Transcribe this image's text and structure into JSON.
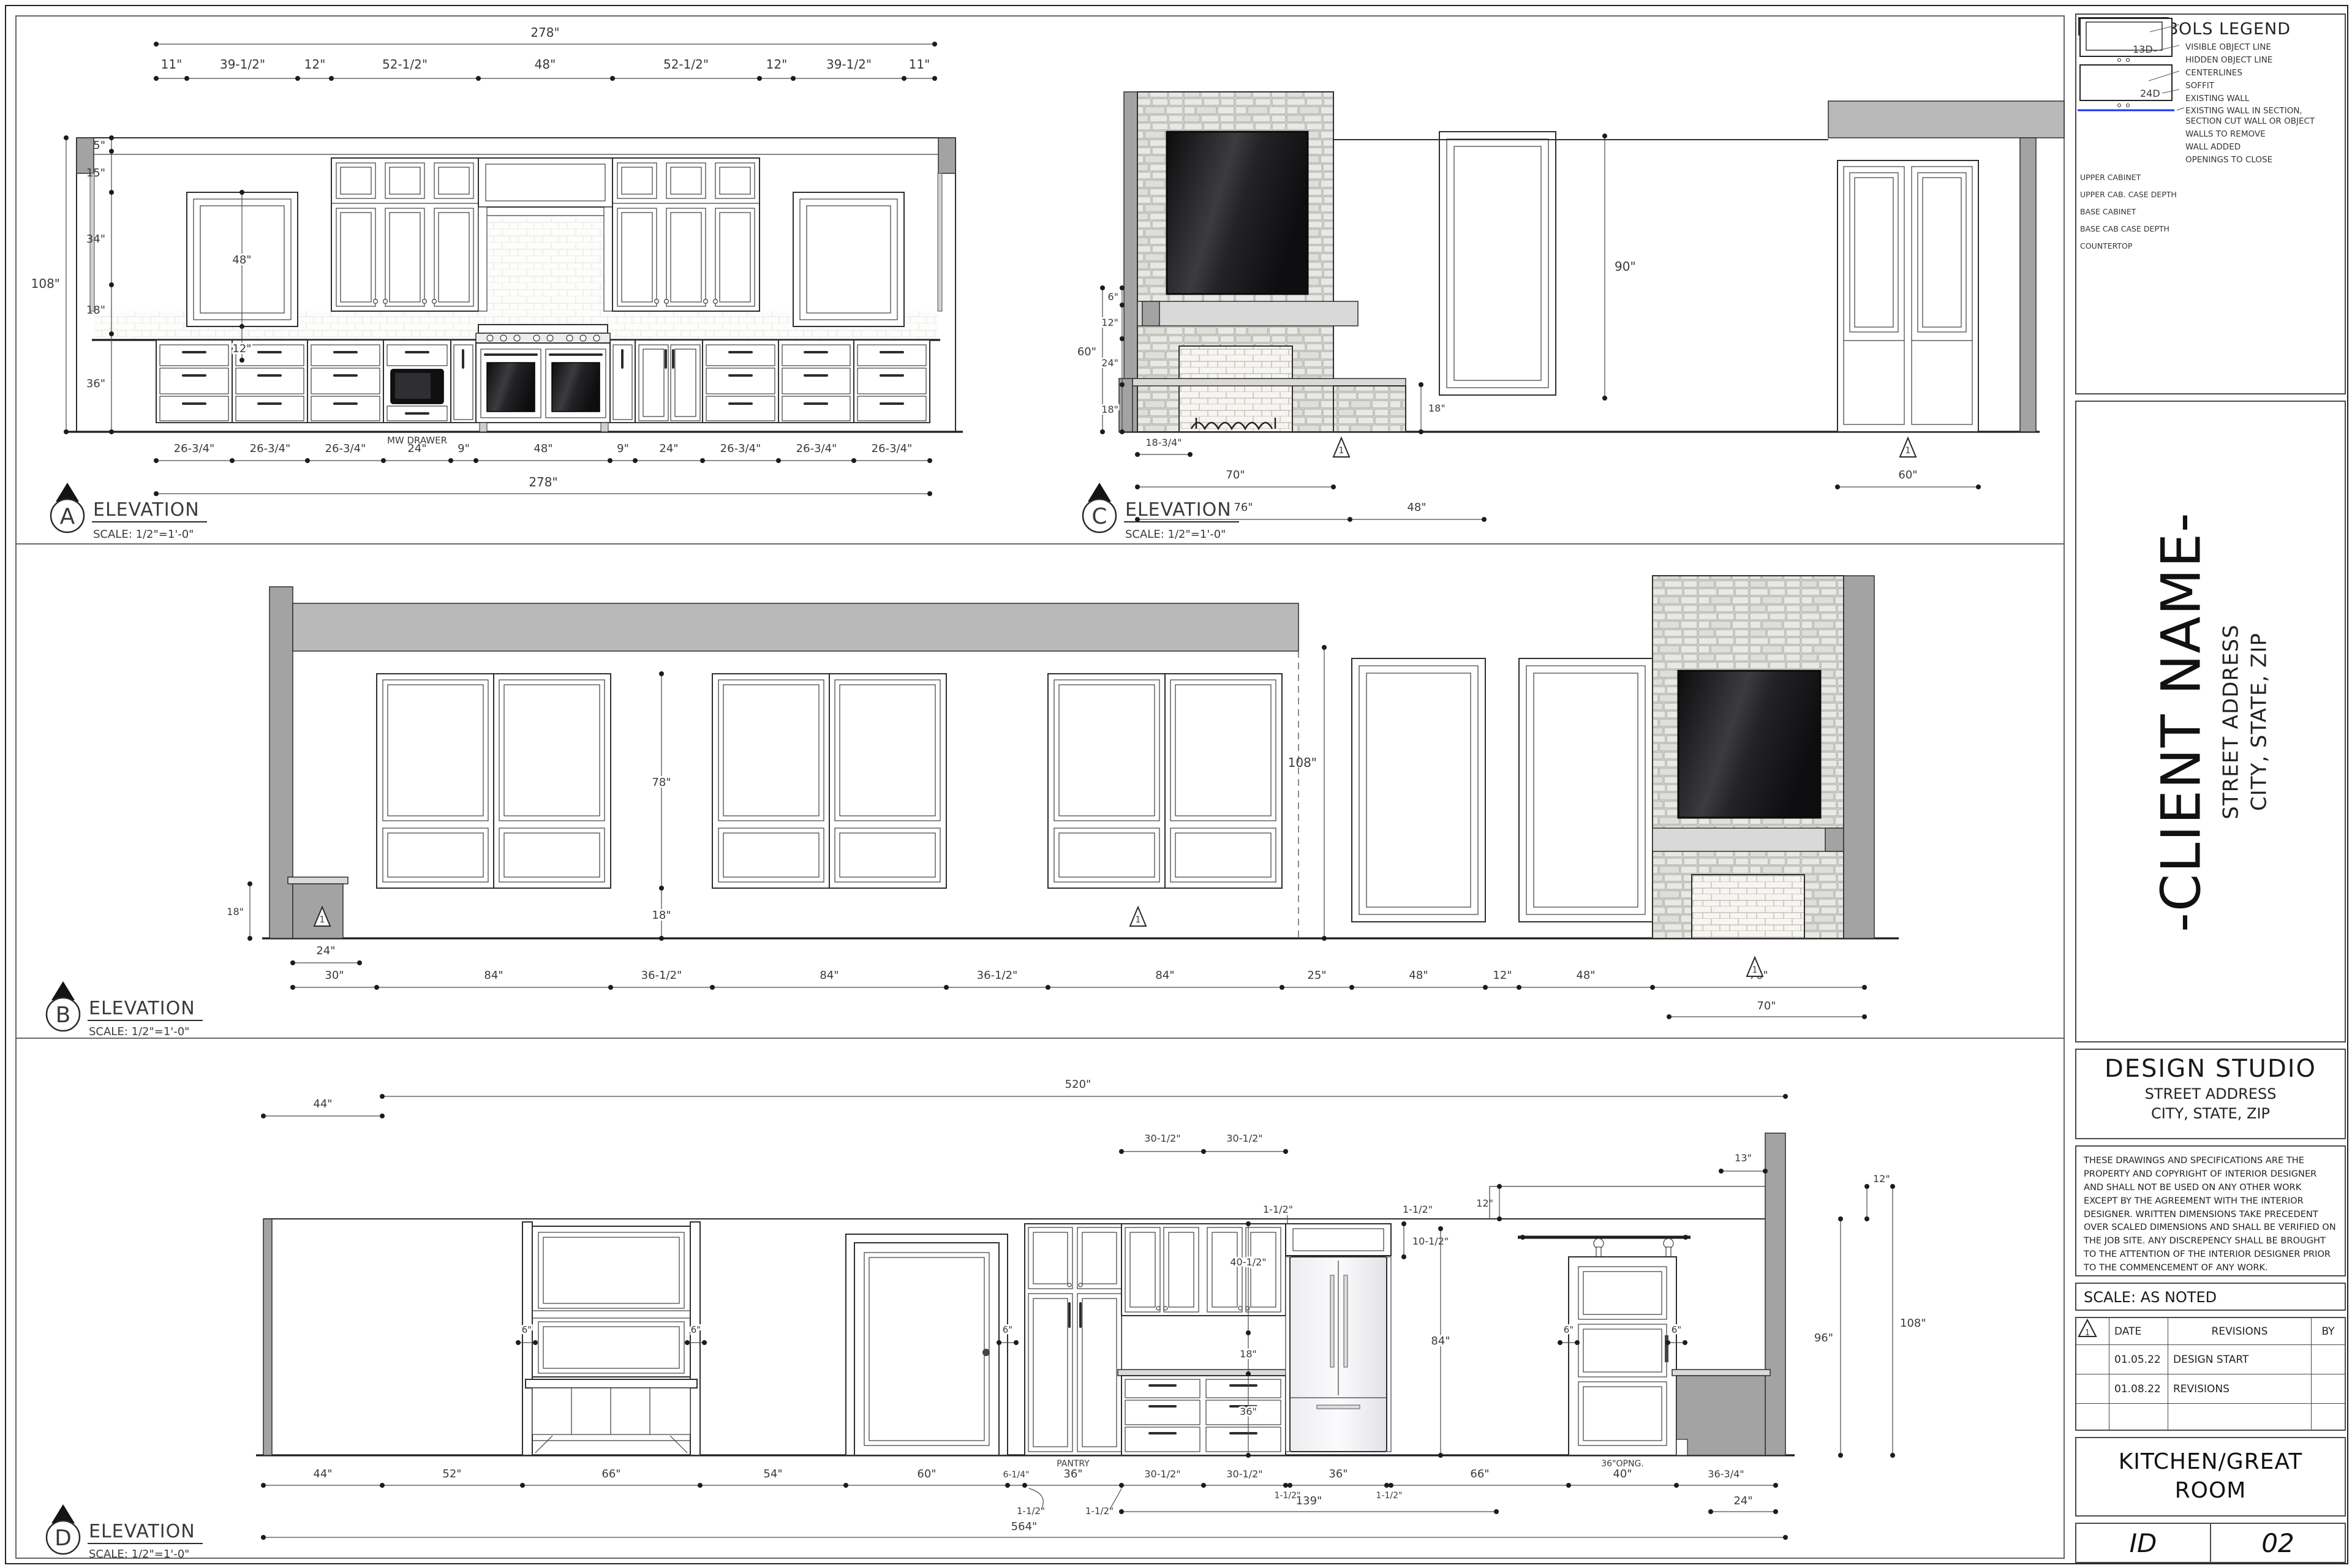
{
  "common": {
    "title": "ELEVATION",
    "scale": "SCALE: 1/2\"=1'-0\""
  },
  "elev_a": {
    "marker": "A",
    "overall_top": "278\"",
    "top": [
      "11\"",
      "39-1/2\"",
      "12\"",
      "52-1/2\"",
      "48\"",
      "52-1/2\"",
      "12\"",
      "39-1/2\"",
      "11\""
    ],
    "left": [
      "5\"",
      "15\"",
      "34\"",
      "18\"",
      "36\""
    ],
    "left_overall": "108\"",
    "win_h": "48\"",
    "sill": "12\"",
    "bottom": [
      "26-3/4\"",
      "26-3/4\"",
      "26-3/4\"",
      "24\"",
      "9\"",
      "48\"",
      "9\"",
      "24\"",
      "26-3/4\"",
      "26-3/4\"",
      "26-3/4\""
    ],
    "overall_bottom": "278\"",
    "mw": "MW DRAWER"
  },
  "elev_c": {
    "marker": "C",
    "left": [
      "6\"",
      "12\"",
      "24\"",
      "18\""
    ],
    "left_overall": "60\"",
    "hearth": "18\"",
    "door_h": "90\"",
    "bottom": [
      "18-3/4\"",
      "70\"",
      "76\"",
      "48\"",
      "60\""
    ],
    "rev": "1"
  },
  "elev_b": {
    "marker": "B",
    "win_h": "78\"",
    "below": "18\"",
    "height": "108\"",
    "cab": "24\"",
    "bottom": [
      "30\"",
      "84\"",
      "36-1/2\"",
      "84\"",
      "36-1/2\"",
      "84\"",
      "25\"",
      "48\"",
      "12\"",
      "48\"",
      "76\""
    ],
    "sub": "70\"",
    "rev": "1"
  },
  "elev_d": {
    "marker": "D",
    "top44": "44\"",
    "top520": "520\"",
    "top305a": "30-1/2\"",
    "top305b": "30-1/2\"",
    "top13": "13\"",
    "d12a": "12\"",
    "d12b": "12\"",
    "d15a": "1-1/2\"",
    "d15b": "1-1/2\"",
    "d105": "10-1/2\"",
    "cab405": "40-1/2\"",
    "gap18": "18\"",
    "base36": "36\"",
    "h84": "84\"",
    "h96": "96\"",
    "h108": "108\"",
    "six": "6\"",
    "bottom": [
      "44\"",
      "52\"",
      "66\"",
      "54\"",
      "60\"",
      "6-1/4\"",
      "36\"",
      "30-1/2\"",
      "30-1/2\"",
      "1-1/2\"",
      "36\"",
      "1-1/2\"",
      "66\"",
      "40\"",
      "36-3/4\""
    ],
    "pantry": "PANTRY",
    "opng": "36\"OPNG.",
    "low15a": "1-1/2\"",
    "low15b": "1-1/2\"",
    "d139": "139\"",
    "d24": "24\"",
    "overall": "564\""
  },
  "legend": {
    "title": "SYMBOLS LEGEND",
    "items": [
      "VISIBLE OBJECT LINE",
      "HIDDEN OBJECT LINE",
      "CENTERLINES",
      "SOFFIT",
      "EXISTING WALL",
      "EXISTING WALL IN SECTION, SECTION CUT WALL OR OBJECT",
      "WALLS TO REMOVE",
      "WALL ADDED",
      "OPENINGS TO CLOSE"
    ],
    "cl_symbol": "℄",
    "cab": {
      "upper": "UPPER CABINET",
      "upper_depth": "UPPER CAB. CASE DEPTH",
      "upper_depth_val": "13D",
      "base": "BASE CABINET",
      "base_depth": "BASE CAB CASE DEPTH",
      "base_depth_val": "24D",
      "countertop": "COUNTERTOP"
    }
  },
  "client": {
    "name": "-CLIENT NAME-",
    "address": "STREET ADDRESS",
    "city": "CITY, STATE, ZIP"
  },
  "studio": {
    "name": "DESIGN STUDIO",
    "address": "STREET ADDRESS",
    "city": "CITY, STATE, ZIP"
  },
  "disclaimer": "THESE DRAWINGS AND SPECIFICATIONS ARE THE PROPERTY AND COPYRIGHT OF INTERIOR DESIGNER AND SHALL NOT BE USED ON ANY OTHER WORK EXCEPT BY THE AGREEMENT WITH THE INTERIOR DESIGNER. WRITTEN DIMENSIONS TAKE PRECEDENT OVER SCALED DIMENSIONS AND SHALL BE VERIFIED ON THE JOB SITE. ANY DISCREPENCY SHALL BE BROUGHT TO THE ATTENTION OF THE INTERIOR DESIGNER PRIOR TO THE COMMENCEMENT OF ANY WORK.",
  "scale_note": "SCALE: AS NOTED",
  "revisions": {
    "header": {
      "sym": "0",
      "date": "DATE",
      "desc": "REVISIONS",
      "by": "BY"
    },
    "rows": [
      {
        "sym": "",
        "date": "01.05.22",
        "desc": "DESIGN START",
        "by": ""
      },
      {
        "sym": "1",
        "date": "01.08.22",
        "desc": "REVISIONS",
        "by": ""
      },
      {
        "sym": "",
        "date": "",
        "desc": "",
        "by": ""
      }
    ]
  },
  "project": "KITCHEN/GREAT ROOM",
  "sheet": {
    "label": "ID",
    "number": "02"
  },
  "colors": {
    "countertop": "#1433ff",
    "section": "#a3a3a3",
    "soffit": "#b9b9b9"
  }
}
